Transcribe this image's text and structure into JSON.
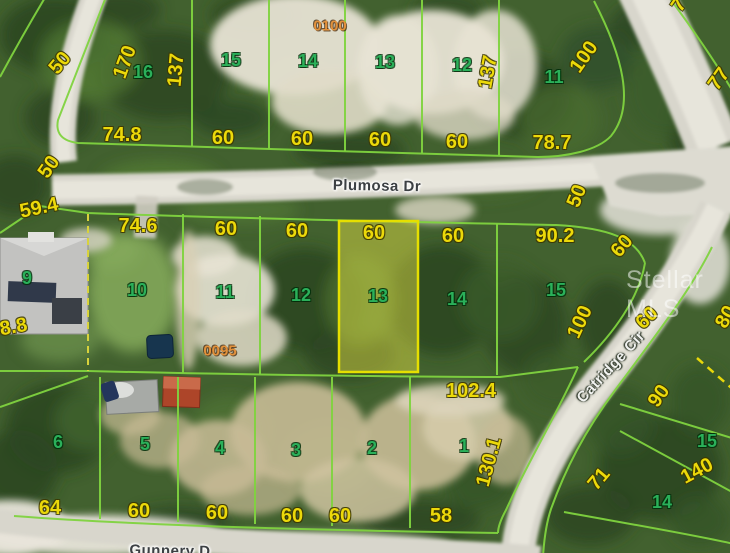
{
  "map": {
    "watermark": "Stellar MLS",
    "colors": {
      "dimension_text": "#ecd90a",
      "lot_text": "#2bb05a",
      "plat_text": "#e2913b",
      "parcel_line": "#7fd33f",
      "highlight_fill": "rgba(235,230,70,0.45)",
      "highlight_border": "#e6df00",
      "road": "#d8d6cc"
    },
    "streets": [
      {
        "name": "Plumosa Dr",
        "x": 377,
        "y": 186,
        "rot": 1,
        "style": "dark"
      },
      {
        "name": "Catridge Cir",
        "x": 611,
        "y": 367,
        "rot": -47,
        "style": "light"
      },
      {
        "name": "Gunnery D",
        "x": 170,
        "y": 551,
        "rot": 1,
        "style": "dark"
      }
    ],
    "plat_numbers": [
      {
        "text": "0100",
        "x": 330,
        "y": 26
      },
      {
        "text": "0095",
        "x": 220,
        "y": 351
      }
    ],
    "lot_numbers": [
      {
        "text": "16",
        "x": 143,
        "y": 72
      },
      {
        "text": "15",
        "x": 231,
        "y": 60
      },
      {
        "text": "14",
        "x": 308,
        "y": 61
      },
      {
        "text": "13",
        "x": 385,
        "y": 62
      },
      {
        "text": "12",
        "x": 462,
        "y": 65
      },
      {
        "text": "11",
        "x": 554,
        "y": 77
      },
      {
        "text": "9",
        "x": 27,
        "y": 278
      },
      {
        "text": "10",
        "x": 137,
        "y": 290
      },
      {
        "text": "11",
        "x": 225,
        "y": 292
      },
      {
        "text": "12",
        "x": 301,
        "y": 295
      },
      {
        "text": "13",
        "x": 378,
        "y": 296
      },
      {
        "text": "14",
        "x": 457,
        "y": 299
      },
      {
        "text": "15",
        "x": 556,
        "y": 290
      },
      {
        "text": "6",
        "x": 58,
        "y": 442
      },
      {
        "text": "5",
        "x": 145,
        "y": 444
      },
      {
        "text": "4",
        "x": 220,
        "y": 448
      },
      {
        "text": "3",
        "x": 296,
        "y": 450
      },
      {
        "text": "2",
        "x": 372,
        "y": 448
      },
      {
        "text": "1",
        "x": 464,
        "y": 446
      },
      {
        "text": "15",
        "x": 707,
        "y": 441
      },
      {
        "text": "14",
        "x": 662,
        "y": 502
      }
    ],
    "dimensions": [
      {
        "text": "170",
        "x": 125,
        "y": 62,
        "rot": -70
      },
      {
        "text": "137",
        "x": 176,
        "y": 70,
        "rot": -85
      },
      {
        "text": "74.8",
        "x": 122,
        "y": 135,
        "rot": 0
      },
      {
        "text": "60",
        "x": 223,
        "y": 138,
        "rot": 0
      },
      {
        "text": "60",
        "x": 302,
        "y": 139,
        "rot": 0
      },
      {
        "text": "60",
        "x": 380,
        "y": 140,
        "rot": 0
      },
      {
        "text": "60",
        "x": 457,
        "y": 142,
        "rot": 0
      },
      {
        "text": "137",
        "x": 488,
        "y": 72,
        "rot": -80
      },
      {
        "text": "100",
        "x": 584,
        "y": 57,
        "rot": -55
      },
      {
        "text": "78.7",
        "x": 552,
        "y": 143,
        "rot": 0
      },
      {
        "text": "50",
        "x": 60,
        "y": 63,
        "rot": -50
      },
      {
        "text": "50",
        "x": 49,
        "y": 167,
        "rot": -55
      },
      {
        "text": "77",
        "x": 719,
        "y": 79,
        "rot": -55
      },
      {
        "text": "7",
        "x": 679,
        "y": 5,
        "rot": -55
      },
      {
        "text": "59.4",
        "x": 39,
        "y": 208,
        "rot": -12
      },
      {
        "text": "74.6",
        "x": 138,
        "y": 226,
        "rot": 0
      },
      {
        "text": "60",
        "x": 226,
        "y": 229,
        "rot": 0
      },
      {
        "text": "60",
        "x": 297,
        "y": 231,
        "rot": 0
      },
      {
        "text": "60",
        "x": 374,
        "y": 233,
        "rot": 0
      },
      {
        "text": "60",
        "x": 453,
        "y": 236,
        "rot": 0
      },
      {
        "text": "90.2",
        "x": 555,
        "y": 236,
        "rot": 0
      },
      {
        "text": "50",
        "x": 577,
        "y": 196,
        "rot": -68
      },
      {
        "text": "60",
        "x": 622,
        "y": 246,
        "rot": -50
      },
      {
        "text": "60",
        "x": 647,
        "y": 318,
        "rot": -45
      },
      {
        "text": "80",
        "x": 726,
        "y": 317,
        "rot": -60
      },
      {
        "text": "100",
        "x": 580,
        "y": 322,
        "rot": -65
      },
      {
        "text": "88.8",
        "x": 8,
        "y": 328,
        "rot": -10
      },
      {
        "text": "102.4",
        "x": 471,
        "y": 391,
        "rot": 0
      },
      {
        "text": "130.1",
        "x": 489,
        "y": 462,
        "rot": -75
      },
      {
        "text": "71",
        "x": 599,
        "y": 479,
        "rot": -50
      },
      {
        "text": "90",
        "x": 659,
        "y": 396,
        "rot": -55
      },
      {
        "text": "140",
        "x": 697,
        "y": 471,
        "rot": -28
      },
      {
        "text": "64",
        "x": 50,
        "y": 508,
        "rot": 0
      },
      {
        "text": "60",
        "x": 139,
        "y": 511,
        "rot": 0
      },
      {
        "text": "60",
        "x": 217,
        "y": 513,
        "rot": 0
      },
      {
        "text": "60",
        "x": 292,
        "y": 516,
        "rot": 0
      },
      {
        "text": "60",
        "x": 340,
        "y": 516,
        "rot": 0
      },
      {
        "text": "58",
        "x": 441,
        "y": 516,
        "rot": 0
      }
    ]
  }
}
